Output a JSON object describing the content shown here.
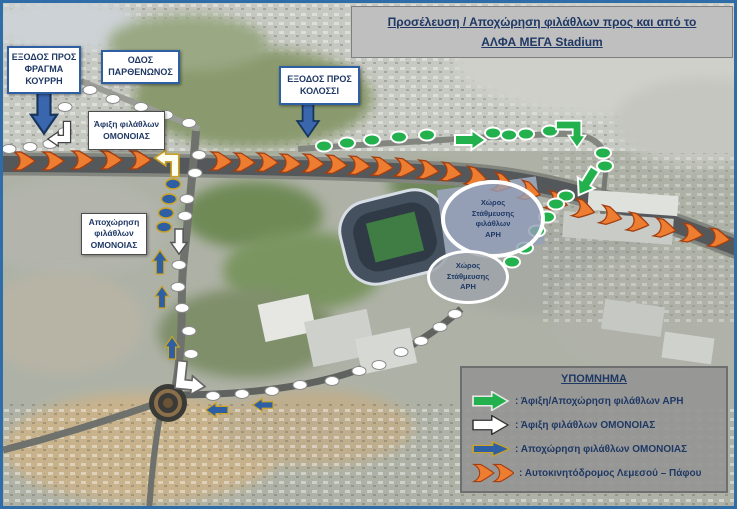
{
  "title": {
    "line1": "Προσέλευση / Αποχώρηση φιλάθλων προς και από το",
    "line2": "ΑΛΦΑ ΜΕΓΑ Stadium"
  },
  "boxes": {
    "kourri": {
      "lines": [
        "ΕΞΟΔΟΣ ΠΡΟΣ",
        "ΦΡΑΓΜΑ",
        "ΚΟΥΡΡΗ"
      ]
    },
    "parthenonos": {
      "lines": [
        "ΟΔΟΣ",
        "ΠΑΡΘΕΝΩΝΟΣ"
      ]
    },
    "kolossi": {
      "lines": [
        "ΕΞΟΔΟΣ ΠΡΟΣ",
        "ΚΟΛΟΣΣΙ"
      ]
    },
    "omonia_arrival": {
      "lines": [
        "Άφιξη φιλάθλων",
        "ΟΜΟΝΟΙΑΣ"
      ]
    },
    "omonia_departure": {
      "lines": [
        "Αποχώρηση",
        "φιλάθλων",
        "ΟΜΟΝΟΙΑΣ"
      ]
    }
  },
  "parking": {
    "ari_fans": {
      "lines": [
        "Χώρος",
        "Στάθμευσης",
        "φιλάθλων",
        "ΑΡΗ"
      ]
    },
    "ari": {
      "lines": [
        "Χώρος",
        "Στάθμευσης",
        "ΑΡΗ"
      ]
    }
  },
  "legend": {
    "title": "ΥΠΟΜΝΗΜΑ",
    "items": [
      {
        "icon": "green-arrow",
        "label": ": Άφιξη/Αποχώρηση φιλάθλων  ΑΡΗ"
      },
      {
        "icon": "white-arrow",
        "label": ": Άφιξη φιλάθλων ΟΜΟΝΟΙΑΣ"
      },
      {
        "icon": "blue-arrow",
        "label": ": Αποχώρηση φιλάθλων ΟΜΟΝΟΙΑΣ"
      },
      {
        "icon": "orange-chevrons",
        "label": ": Αυτοκινητόδρομος Λεμεσού – Πάφου"
      }
    ]
  },
  "colors": {
    "ari_green": "#22B14C",
    "omonia_arrival_white": "#FFFFFF",
    "omonia_departure_blue": "#2E5FA3",
    "departure_outline_tan": "#C9A227",
    "highway_orange": "#ED7D31",
    "box_border_blue": "#2E5FA3",
    "label_navy": "#1F3864",
    "title_bg_gray": "#BFBFBF",
    "legend_bg_gray": "#969694"
  },
  "map_overlay": {
    "dot_groups": [
      {
        "name": "omonia-arrival-route",
        "fill": "#FFFFFF",
        "stroke": "#8a8a8a",
        "sw": 1,
        "rx": 7,
        "ry": 4.5,
        "points": [
          [
            6,
            146
          ],
          [
            27,
            144
          ],
          [
            47,
            141
          ],
          [
            62,
            104
          ],
          [
            62,
            129
          ],
          [
            87,
            87
          ],
          [
            110,
            96
          ],
          [
            138,
            104
          ],
          [
            163,
            112
          ],
          [
            186,
            120
          ],
          [
            196,
            152
          ],
          [
            192,
            170
          ],
          [
            184,
            196
          ],
          [
            182,
            213
          ],
          [
            176,
            262
          ],
          [
            175,
            284
          ],
          [
            179,
            305
          ],
          [
            186,
            328
          ],
          [
            188,
            351
          ],
          [
            210,
            393
          ],
          [
            239,
            391
          ],
          [
            269,
            388
          ],
          [
            297,
            382
          ],
          [
            329,
            378
          ],
          [
            356,
            368
          ],
          [
            376,
            362
          ],
          [
            398,
            349
          ],
          [
            418,
            338
          ],
          [
            437,
            324
          ],
          [
            452,
            311
          ]
        ]
      },
      {
        "name": "ari-route",
        "fill": "#22B14C",
        "stroke": "#FFFFFF",
        "sw": 2,
        "rx": 8,
        "ry": 5.5,
        "points": [
          [
            321,
            143
          ],
          [
            344,
            140
          ],
          [
            369,
            137
          ],
          [
            396,
            134
          ],
          [
            424,
            132
          ],
          [
            490,
            130
          ],
          [
            506,
            132
          ],
          [
            523,
            131
          ],
          [
            547,
            128
          ],
          [
            600,
            150
          ],
          [
            602,
            163
          ],
          [
            563,
            193
          ],
          [
            553,
            201
          ],
          [
            544,
            214
          ],
          [
            534,
            228
          ],
          [
            522,
            245
          ],
          [
            509,
            259
          ]
        ]
      },
      {
        "name": "omonia-departure-route",
        "fill": "#2E5FA3",
        "stroke": "#C9A227",
        "sw": 1.5,
        "rx": 7.5,
        "ry": 5,
        "points": [
          [
            170,
            181
          ],
          [
            166,
            196
          ],
          [
            163,
            210
          ],
          [
            161,
            224
          ]
        ]
      }
    ],
    "chevrons": {
      "name": "highway-chevron",
      "fill": "#ED7D31",
      "stroke": "#A33E12",
      "sw": 1.3,
      "points": [
        [
          11,
          158,
          0
        ],
        [
          40,
          158,
          0
        ],
        [
          69,
          157,
          0
        ],
        [
          98,
          157,
          0
        ],
        [
          127,
          157,
          0
        ],
        [
          208,
          158,
          2
        ],
        [
          231,
          159,
          2
        ],
        [
          254,
          159,
          2
        ],
        [
          277,
          160,
          3
        ],
        [
          300,
          160,
          3
        ],
        [
          323,
          161,
          4
        ],
        [
          346,
          162,
          4
        ],
        [
          369,
          163,
          5
        ],
        [
          392,
          164,
          6
        ],
        [
          415,
          166,
          7
        ],
        [
          438,
          168,
          9
        ],
        [
          463,
          172,
          12
        ],
        [
          490,
          178,
          14
        ],
        [
          517,
          186,
          16
        ],
        [
          544,
          196,
          17
        ],
        [
          571,
          204,
          15
        ],
        [
          598,
          211,
          13
        ],
        [
          625,
          218,
          11
        ],
        [
          652,
          224,
          10
        ],
        [
          679,
          229,
          9
        ],
        [
          706,
          234,
          8
        ]
      ]
    },
    "arrows": [
      {
        "name": "kourri-exit-down-arrow",
        "sym": "block",
        "t": "translate(41,90) rotate(90) scale(1.45)",
        "fill": "#3A66AD",
        "stroke": "#17365D",
        "sw": 1.5
      },
      {
        "name": "kolossi-exit-down-arrow",
        "sym": "block",
        "t": "translate(305,100) rotate(90) scale(1.2)",
        "fill": "#3A66AD",
        "stroke": "#17365D",
        "sw": 1.5
      },
      {
        "name": "omonia-arrival-down-arrow",
        "sym": "block",
        "t": "translate(176,226) rotate(90) scale(0.9)",
        "fill": "#FFFFFF",
        "stroke": "#555555",
        "sw": 1.6
      },
      {
        "name": "omonia-arrival-exit-elbow-arrow",
        "sym": "elbow",
        "t": "translate(64,136) scale(-0.8,0.8)",
        "fill": "#FFFFFF",
        "stroke": "#444444",
        "sw": 1.6
      },
      {
        "name": "omonia-departure-merge-elbow-arrow",
        "sym": "elbow",
        "t": "translate(172,155) rotate(180) scale(0.85)",
        "fill": "#FDFDF2",
        "stroke": "#C9A227",
        "sw": 2
      },
      {
        "name": "omonia-arrival-turn-elbow-arrow",
        "sym": "elbow",
        "t": "translate(177,381) rotate(6) scale(1.05)",
        "fill": "#FFFFFF",
        "stroke": "#666666",
        "sw": 1.6
      },
      {
        "name": "omonia-departure-up-arrow-1",
        "sym": "block",
        "t": "translate(157,271) rotate(-90) scale(0.85)",
        "fill": "#2E5FA3",
        "stroke": "#C9A227",
        "sw": 1.6
      },
      {
        "name": "omonia-departure-up-arrow-2",
        "sym": "block",
        "t": "translate(159,305) rotate(-90) scale(0.78)",
        "fill": "#2E5FA3",
        "stroke": "#C9A227",
        "sw": 1.6
      },
      {
        "name": "omonia-departure-up-arrow-3",
        "sym": "block",
        "t": "translate(169,356) rotate(-90) scale(0.8)",
        "fill": "#2E5FA3",
        "stroke": "#C9A227",
        "sw": 1.6
      },
      {
        "name": "omonia-departure-left-arrow-1",
        "sym": "block",
        "t": "translate(225,407) rotate(180) scale(0.8)",
        "fill": "#2E5FA3",
        "stroke": "#C9A227",
        "sw": 1.6
      },
      {
        "name": "omonia-departure-left-arrow-2",
        "sym": "block",
        "t": "translate(270,402) rotate(180) scale(0.72)",
        "fill": "#2E5FA3",
        "stroke": "#C9A227",
        "sw": 1.6
      },
      {
        "name": "ari-route-right-arrow",
        "sym": "block",
        "t": "translate(452,137) scale(1.1)",
        "fill": "#22B14C",
        "stroke": "#FFFFFF",
        "sw": 1.8
      },
      {
        "name": "ari-route-turn-down-elbow-arrow",
        "sym": "elbow",
        "t": "translate(574,122) scale(1,-1) rotate(-90) scale(0.95)",
        "fill": "#22B14C",
        "stroke": "#FFFFFF",
        "sw": 1.8
      },
      {
        "name": "ari-route-down-arrow",
        "sym": "block",
        "t": "translate(592,166) rotate(122) scale(1.1)",
        "fill": "#22B14C",
        "stroke": "#FFFFFF",
        "sw": 1.8
      }
    ]
  }
}
